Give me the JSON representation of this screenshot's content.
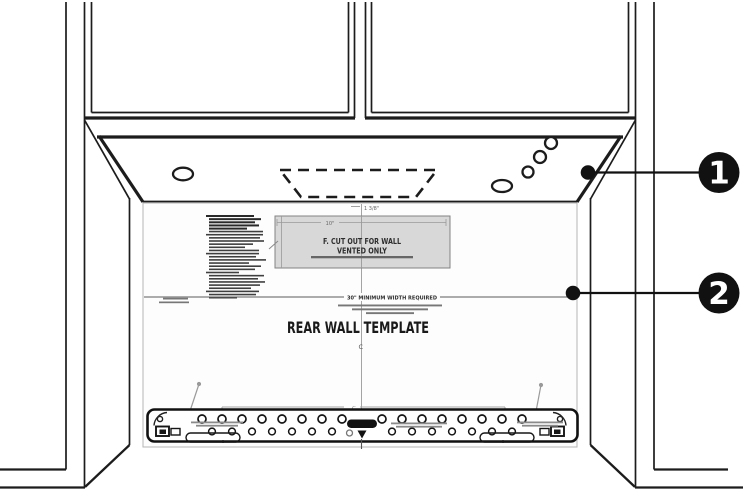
{
  "figure": {
    "type": "installation-diagram",
    "callouts": [
      {
        "number": "1"
      },
      {
        "number": "2"
      }
    ],
    "template_sheet": {
      "title": "REAR WALL TEMPLATE",
      "cutout_box": {
        "line1": "F. CUT OUT FOR WALL",
        "line2": "VENTED ONLY"
      },
      "min_width_line": "30\" MINIMUM WIDTH REQUIRED",
      "top_dimension": "1 3/8\"",
      "cutout_width_dimension": "10\"",
      "centerline_symbol": "C",
      "bracket_width_symbol": "C"
    },
    "colors": {
      "line": "#1c1c1c",
      "cutout_fill": "#d8d8d8",
      "paper": "#fdfdfd",
      "callout_fill": "#111111",
      "dim_gray": "#8a8a8a"
    }
  }
}
